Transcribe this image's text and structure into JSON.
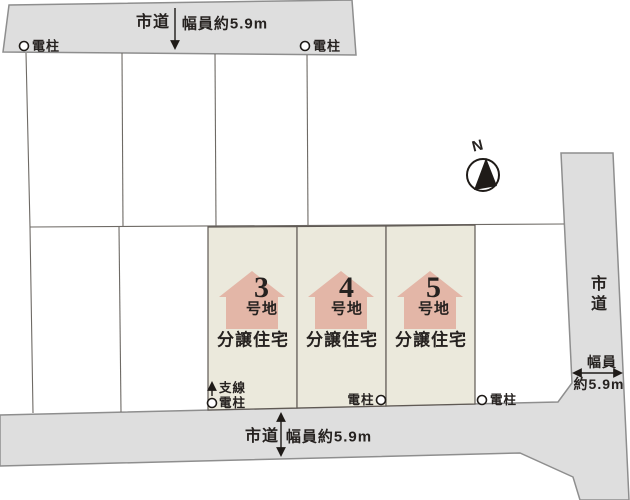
{
  "roads": {
    "top": {
      "name": "市道",
      "width": "幅員約5.9m"
    },
    "bottom": {
      "name": "市道",
      "width": "幅員約5.9m"
    },
    "right": {
      "name": "市道",
      "width_line1": "幅員",
      "width_line2": "約5.9m"
    }
  },
  "poles": {
    "top_left": "電柱",
    "top_right": "電柱",
    "lot3_wire": "支線",
    "lot3_pole": "電柱",
    "middle": "電柱",
    "right": "電柱"
  },
  "compass": {
    "north": "N"
  },
  "lots": [
    {
      "number": "3",
      "unit": "号地",
      "category": "分譲住宅"
    },
    {
      "number": "4",
      "unit": "号地",
      "category": "分譲住宅"
    },
    {
      "number": "5",
      "unit": "号地",
      "category": "分譲住宅"
    }
  ],
  "colors": {
    "road_fill": "#dedede",
    "road_border": "#8e8e8e",
    "lot_fill": "#ebe9dc",
    "lot_border": "#5f5954",
    "house_fill": "#e3b6a7",
    "plot_line": "#6e6a65",
    "text": "#262220",
    "ink": "#1f1b18"
  }
}
